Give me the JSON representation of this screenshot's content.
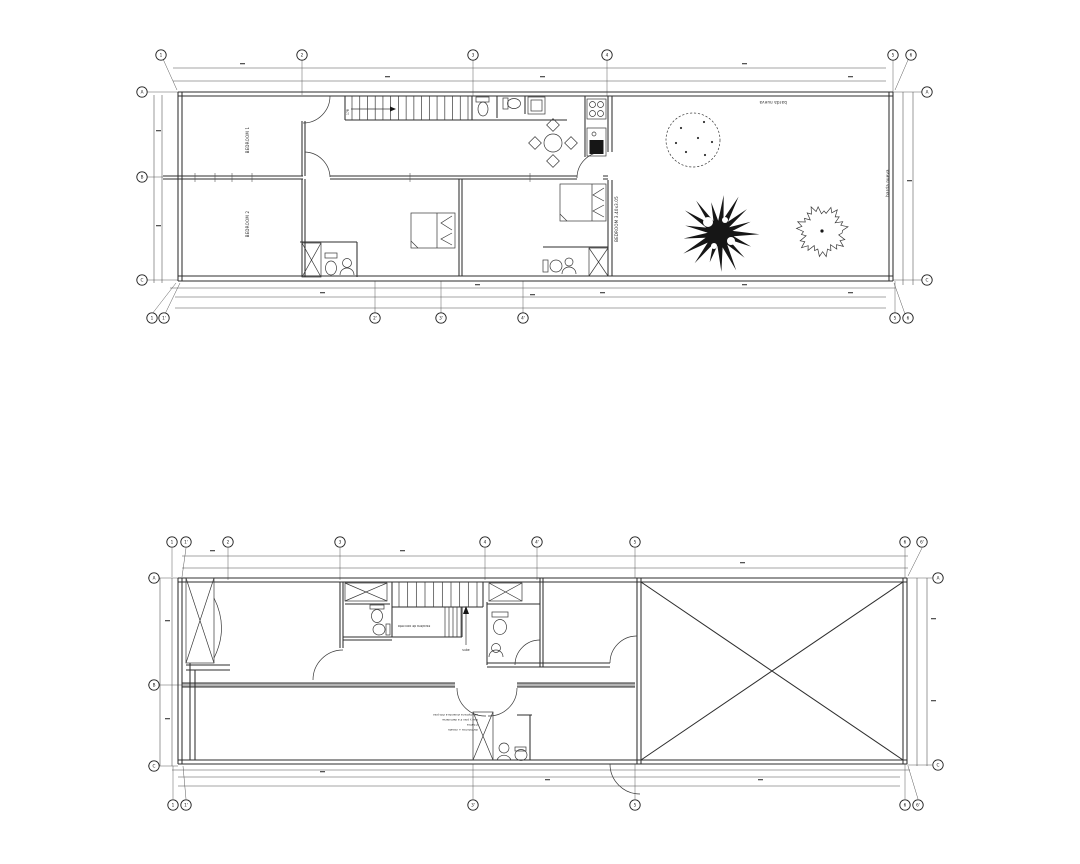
{
  "document": {
    "type": "architectural-floor-plan-sheet",
    "background_color": "#ffffff",
    "line_color": "#2e2e2e",
    "wall_fill_color": "#b4b4b4",
    "tree_fill_color": "#161616"
  },
  "plan_upper": {
    "name": "ground floor plan",
    "labels": {
      "bedroom1": "BEDROOM 1",
      "bedroom2": "BEDROOM 2",
      "bedroom3": "BEDROOM 3.40x3.05",
      "garden": "barda nueva",
      "garden_side": "barda nueva",
      "stair": "17R"
    },
    "grid": {
      "top": [
        "1",
        "2",
        "3",
        "4",
        "5",
        "6"
      ],
      "bottom": [
        "1",
        "1'",
        "2'",
        "3'",
        "4'",
        "5",
        "6"
      ],
      "left": [
        "A",
        "B",
        "C"
      ],
      "right": [
        "A",
        "C"
      ]
    }
  },
  "plan_lower": {
    "name": "upper floor plan",
    "labels": {
      "stair_note": "escalera de concreto",
      "stair_dir": "sube"
    },
    "notes": [
      "dormitorios + closets",
      "2 baños",
      "losa y piso 2 a demolerse",
      "se amplia la vivienda a 2do piso"
    ],
    "grid": {
      "top": [
        "1",
        "1'",
        "2",
        "3",
        "4",
        "4'",
        "5",
        "6",
        "6'"
      ],
      "bottom": [
        "1",
        "1'",
        "3'",
        "5",
        "6",
        "6'"
      ],
      "left": [
        "A",
        "B",
        "C"
      ],
      "right": [
        "A",
        "C"
      ]
    }
  }
}
